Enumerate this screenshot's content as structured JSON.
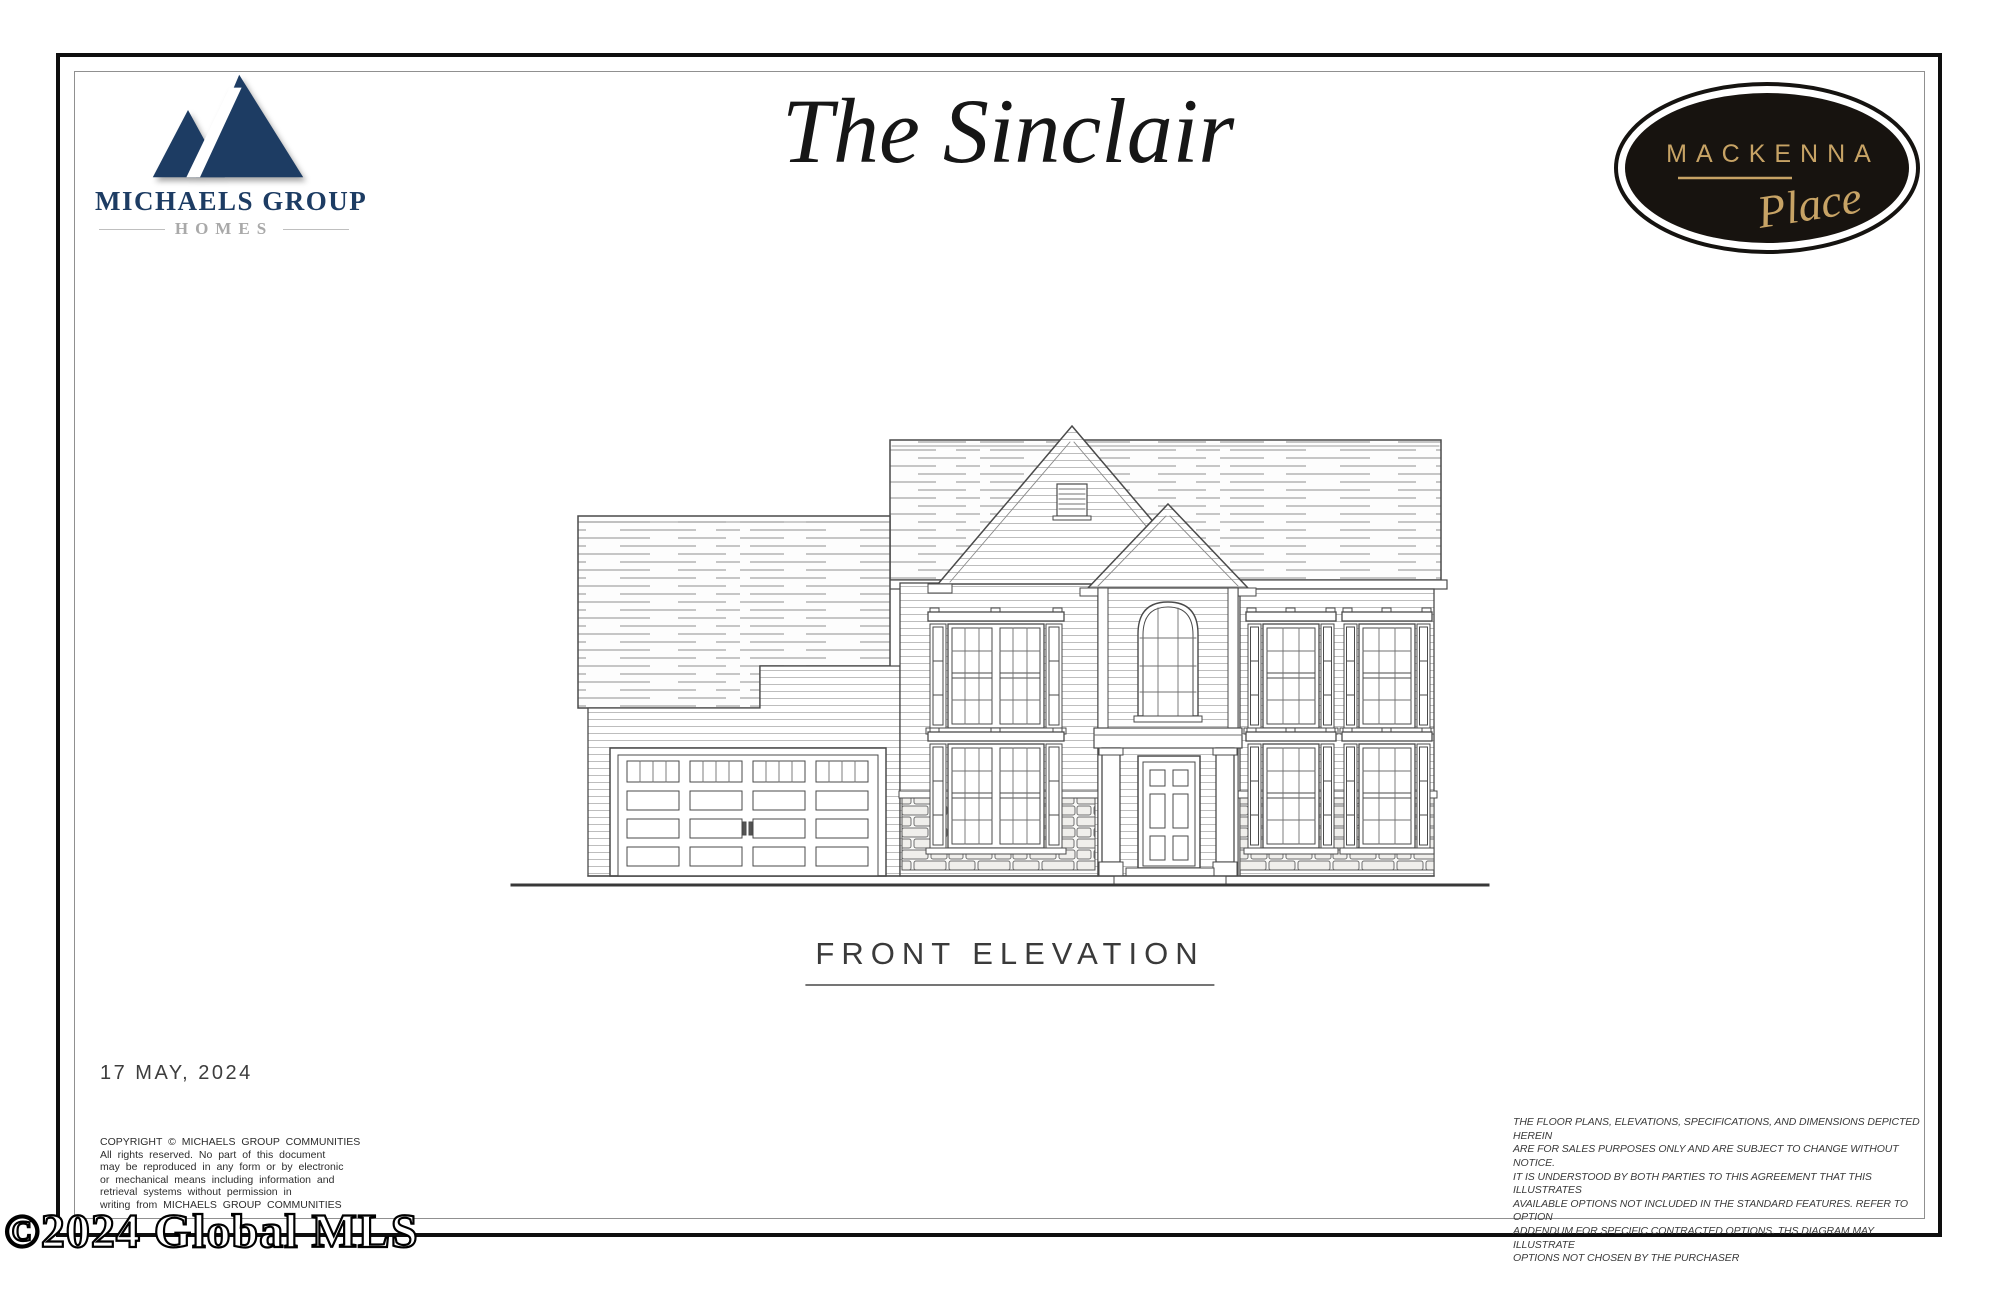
{
  "branding": {
    "michaels": {
      "name": "MICHAELS GROUP",
      "division": "HOMES",
      "navy": "#1d3c63"
    },
    "badge": {
      "community": "MACKENNA",
      "suffix": "Place",
      "background": "#17130f",
      "gold": "#c7a365"
    }
  },
  "title": "The Sinclair",
  "drawing": {
    "label": "FRONT ELEVATION",
    "date": "17 MAY, 2024",
    "subject": "Two-story single family home front elevation with attached garage"
  },
  "legal": {
    "copyright": "COPYRIGHT © MICHAELS GROUP COMMUNITIES\nAll rights reserved.  No part of this document\nmay be reproduced in any form or by electronic\nor mechanical means including information and\nretrieval systems without permission in\nwriting from MICHAELS GROUP COMMUNITIES",
    "disclaimer": "THE FLOOR PLANS, ELEVATIONS, SPECIFICATIONS, AND DIMENSIONS DEPICTED HEREIN\nARE FOR SALES PURPOSES ONLY AND ARE SUBJECT TO CHANGE WITHOUT NOTICE.\nIT IS UNDERSTOOD BY BOTH PARTIES TO THIS AGREEMENT THAT THIS ILLUSTRATES\nAVAILABLE OPTIONS NOT INCLUDED IN THE STANDARD FEATURES.  REFER TO OPTION\nADDENDUM FOR SPECIFIC CONTRACTED OPTIONS.  THS DIAGRAM MAY ILLUSTRATE\nOPTIONS NOT CHOSEN BY THE PURCHASER"
  },
  "watermark": "©2024 Global MLS"
}
